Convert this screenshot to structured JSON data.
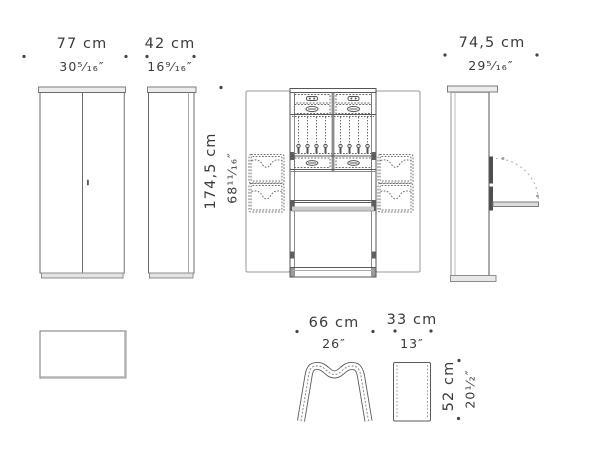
{
  "palette": {
    "background": "#ffffff",
    "line_dark": "#4f4f4f",
    "line_mid": "#8a8a8a",
    "line_light": "#b5b5b5",
    "fill_cap": "#e8e8e8",
    "fill_band": "#c9c9c9",
    "text": "#3a3a3a"
  },
  "dimensions": {
    "wardrobe_width": {
      "cm": "77 cm",
      "inches": "30⁵⁄₁₆″"
    },
    "wardrobe_depth": {
      "cm": "42 cm",
      "inches": "16⁹⁄₁₆″"
    },
    "wardrobe_height": {
      "cm": "174,5 cm",
      "inches": "68¹¹⁄₁₆″"
    },
    "open_depth": {
      "cm": "74,5 cm",
      "inches": "29⁵⁄₁₆″"
    },
    "stool_width": {
      "cm": "66 cm",
      "inches": "26″"
    },
    "stool_depth": {
      "cm": "33 cm",
      "inches": "13″"
    },
    "stool_height": {
      "cm": "52 cm",
      "inches": "20¹⁄₂″"
    }
  }
}
